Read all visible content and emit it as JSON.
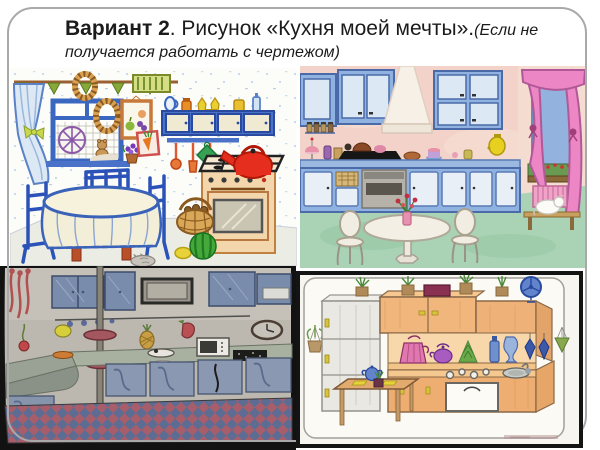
{
  "slide": {
    "background": "#ffffff",
    "frame_color": "#a9a9a9",
    "title": {
      "bold": "Вариант 2",
      "regular": ". Рисунок «Кухня моей мечты».",
      "italic_inline": "(Если не",
      "italic_line2": "получается работать с чертежом)",
      "color": "#1b1b1b"
    }
  },
  "images": [
    {
      "name": "kitchen-drawing-felt-pen",
      "alt": "Детский рисунок фломастерами: кухня с окном, синими шторами, навесным шкафом, газовой плитой с красным чайником и круглым столом со скатертью",
      "key_colors": [
        "#3a68c0",
        "#e62e1e",
        "#f4d6ac",
        "#dce8f4"
      ]
    },
    {
      "name": "kitchen-drawing-watercolor",
      "alt": "Акварельный рисунок: розовая кухня с голубым гарнитуром, вытяжкой, окном с розовыми шторами, белым круглым столом и котом на скамейке",
      "key_colors": [
        "#f3d3c9",
        "#8fb2e0",
        "#a9d3b4",
        "#ec86c4"
      ]
    },
    {
      "name": "kitchen-drawing-pencil",
      "alt": "Карандашный рисунок кухни с длинной стойкой, мойкой, микроволновкой, варочной панелью и ромбическим кафельным полом",
      "key_colors": [
        "#7a8cab",
        "#a85e6a",
        "#5c6c92",
        "#b5b1a9"
      ]
    },
    {
      "name": "kitchen-drawing-colored-pencil",
      "alt": "Рисунок цветными карандашами: деревянный кухонный гарнитур с холодильником, чайниками, бутылками, мойкой, плитой, столиком и комнатными растениями",
      "key_colors": [
        "#f0b67c",
        "#e9e8e2",
        "#6284cc",
        "#e078b0"
      ]
    }
  ]
}
